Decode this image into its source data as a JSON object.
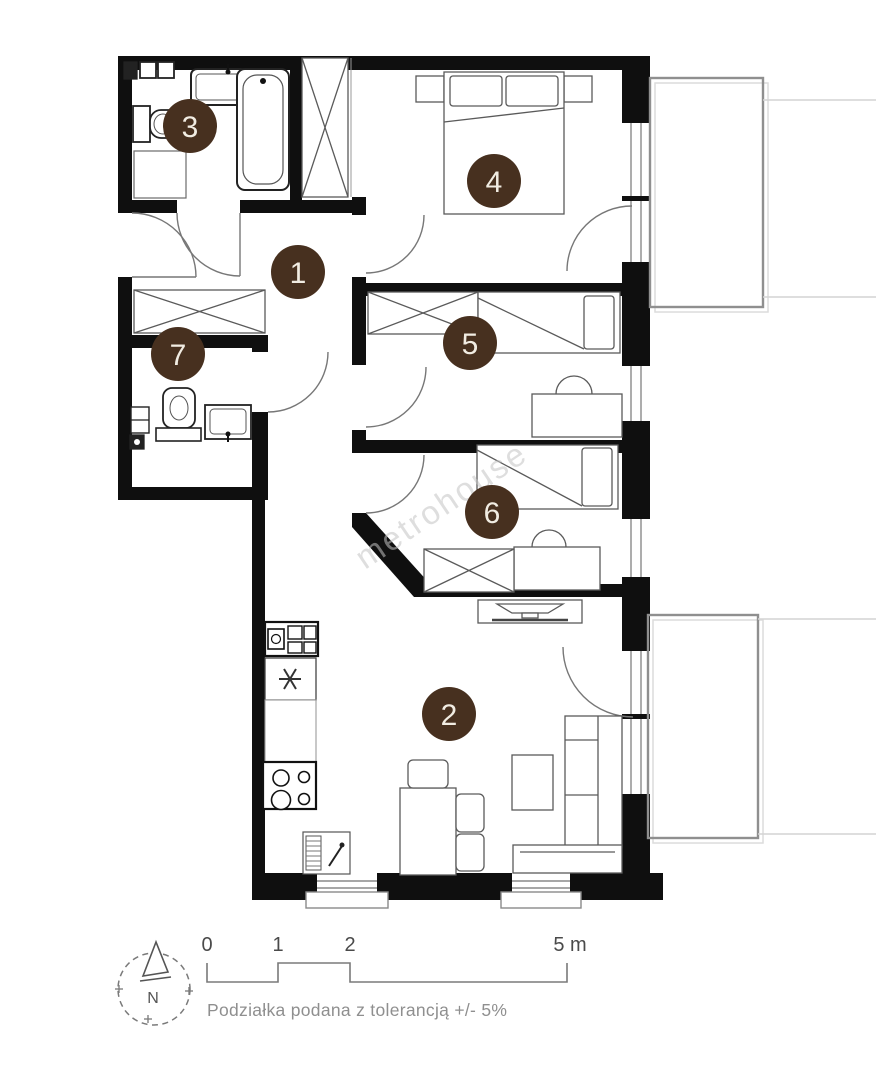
{
  "plan": {
    "watermark": "metrohouse",
    "colors": {
      "wall": "#0f0f0f",
      "marker": "#47301f",
      "marker_text": "#f1ece2",
      "furniture_line": "#5a5a5a",
      "door_line": "#777777",
      "balcony_line": "#8f8f8f",
      "watermark": "#c4c4c4"
    },
    "rooms": [
      {
        "number": "1"
      },
      {
        "number": "2"
      },
      {
        "number": "3"
      },
      {
        "number": "4"
      },
      {
        "number": "5"
      },
      {
        "number": "6"
      },
      {
        "number": "7"
      }
    ]
  },
  "legend": {
    "compass_label": "N",
    "scale_ticks": [
      "0",
      "1",
      "2",
      "5 m"
    ],
    "tolerance_note": "Podziałka podana z tolerancją +/- 5%"
  }
}
